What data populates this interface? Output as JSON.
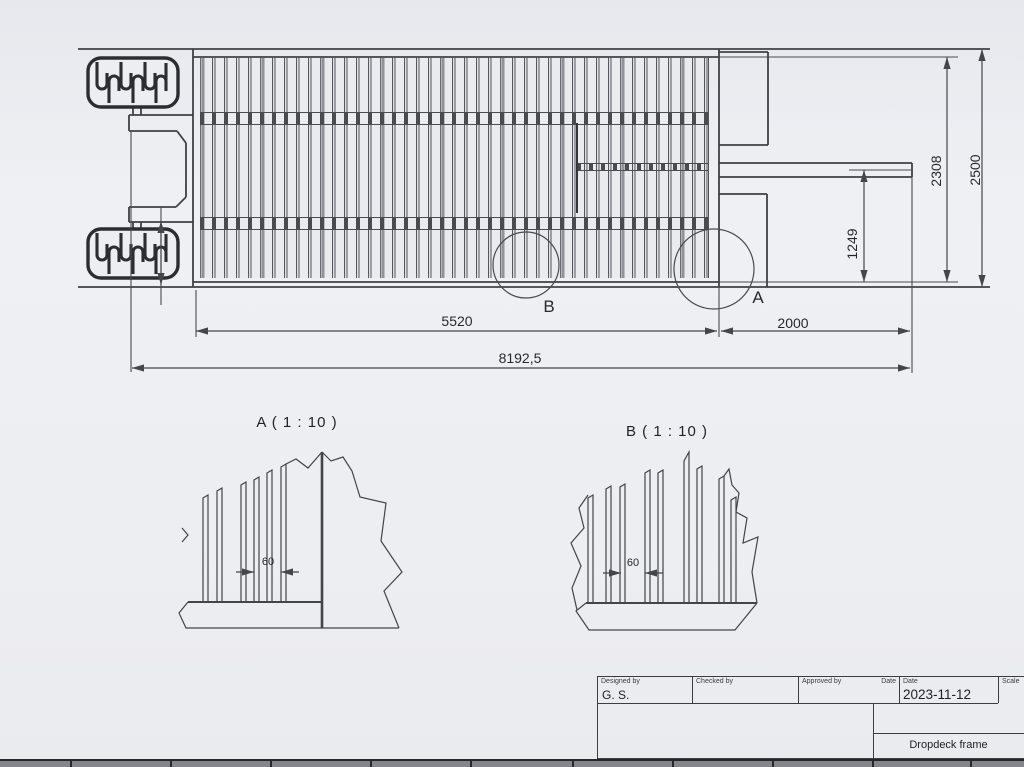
{
  "main_view": {
    "dims": {
      "overall_length": "8192,5",
      "deck_length": "5520",
      "rear_length": "2000",
      "overall_width": "2500",
      "deck_width": "2308",
      "drawbar_offset": "1249"
    },
    "markers": {
      "a": "A",
      "b": "B"
    }
  },
  "detail_a": {
    "title": "A ( 1 : 10 )",
    "slat_spacing": "60"
  },
  "detail_b": {
    "title": "B ( 1 : 10 )",
    "slat_spacing": "60"
  },
  "title_block": {
    "designed_by_label": "Designed by",
    "designed_by_value": "G. S.",
    "checked_by_label": "Checked by",
    "approved_by_label": "Approved by",
    "date_label_1": "Date",
    "date_label_2": "Date",
    "date_value": "2023-11-12",
    "scale_label": "Scale",
    "drawing_title": "Dropdeck frame"
  },
  "colors": {
    "paper": "#edeef2",
    "line": "#45464b",
    "line_dark": "#2c2d31"
  }
}
